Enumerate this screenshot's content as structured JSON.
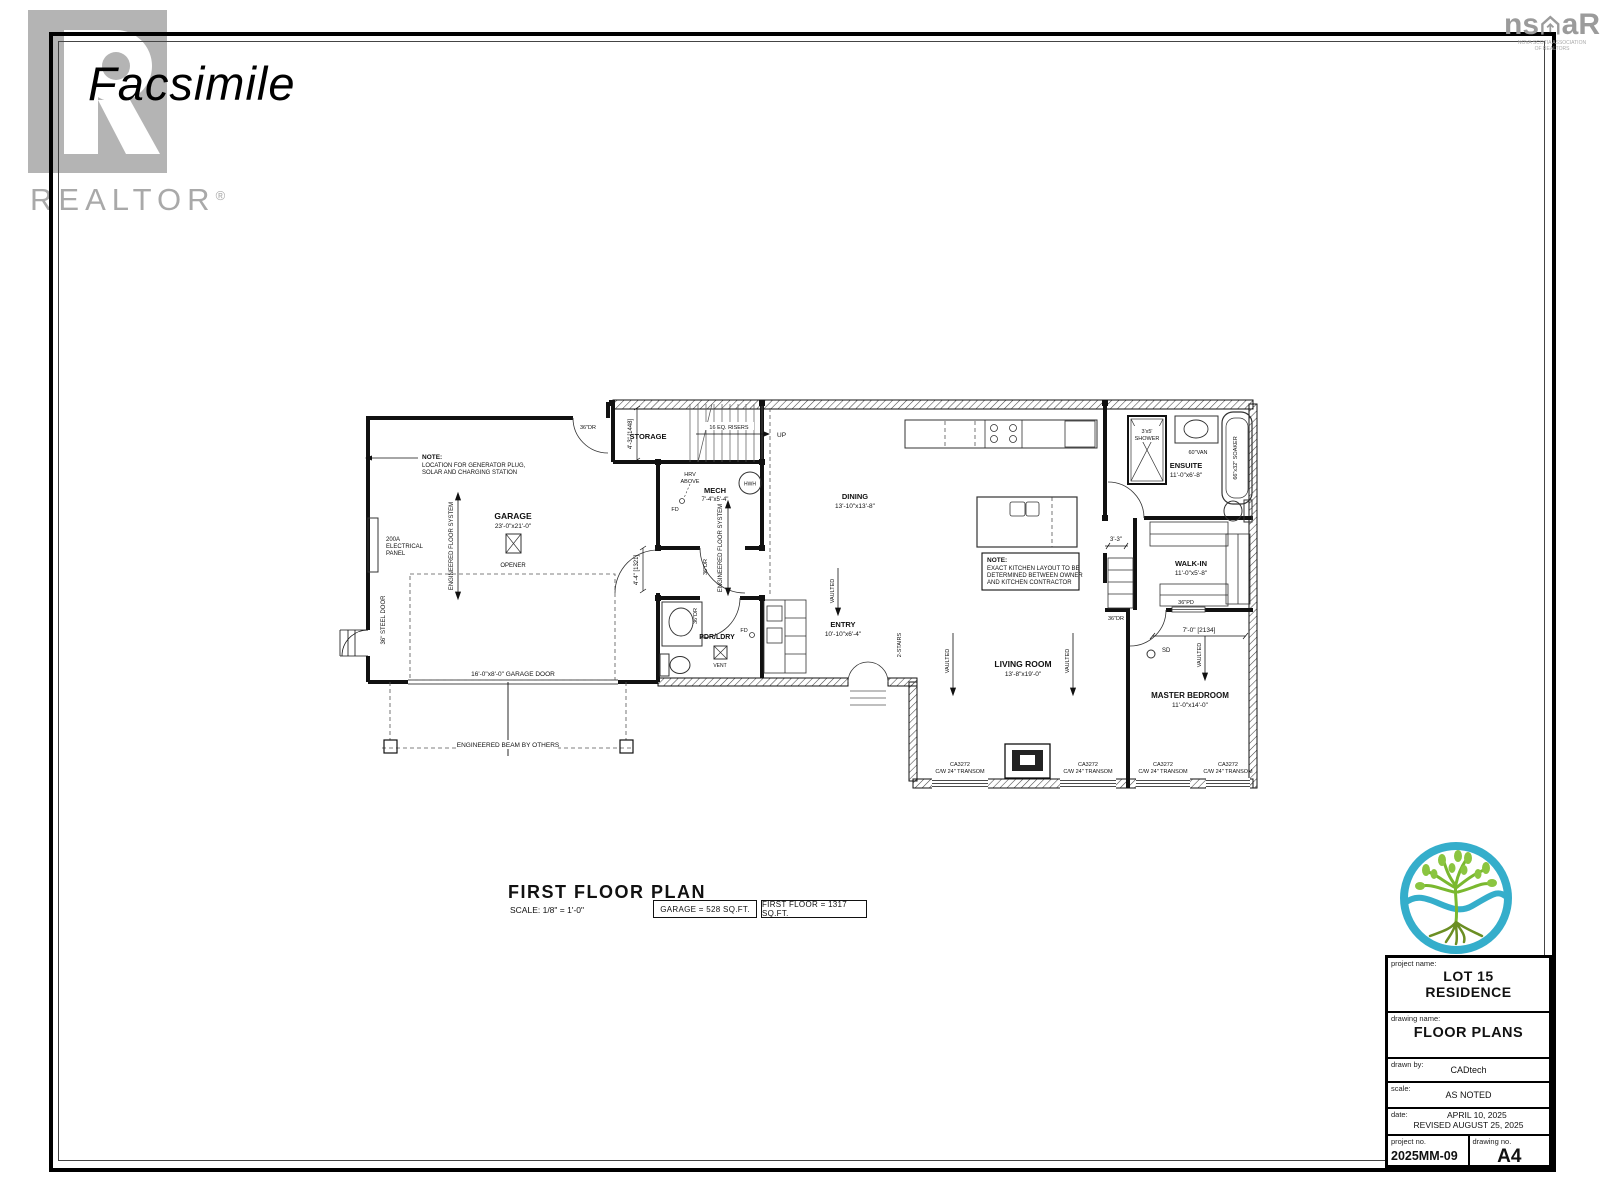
{
  "watermark": {
    "text": "Facsimile"
  },
  "realtor": {
    "wordmark": "REALTOR",
    "reg": "®"
  },
  "nsar": {
    "left": "ns",
    "right": "aR",
    "sub1": "NOVA SCOTIA ASSOCIATION",
    "sub2": "OF REALTORS"
  },
  "plan": {
    "rooms": {
      "garage": {
        "name": "GARAGE",
        "dims": "23'-0\"x21'-0\""
      },
      "storage": {
        "name": "STORAGE"
      },
      "mech": {
        "name": "MECH",
        "dims": "7'-4\"x5'-4\""
      },
      "dining": {
        "name": "DINING",
        "dims": "13'-10\"x13'-8\""
      },
      "pdr": {
        "name": "PDR/LDRY"
      },
      "entry": {
        "name": "ENTRY",
        "dims": "10'-10\"x6'-4\""
      },
      "living": {
        "name": "LIVING ROOM",
        "dims": "13'-8\"x19'-0\""
      },
      "master": {
        "name": "MASTER BEDROOM",
        "dims": "11'-0\"x14'-0\""
      },
      "walkin": {
        "name": "WALK-IN",
        "dims": "11'-0\"x5'-8\""
      },
      "ensuite": {
        "name": "ENSUITE",
        "dims": "11'-0\"x6'-8\""
      }
    },
    "notes": {
      "generator": {
        "title": "NOTE:",
        "l1": "LOCATION FOR GENERATOR PLUG,",
        "l2": "SOLAR AND CHARGING STATION"
      },
      "kitchen": {
        "title": "NOTE:",
        "l1": "EXACT KITCHEN LAYOUT TO BE",
        "l2": "DETERMINED BETWEEN OWNER",
        "l3": "AND KITCHEN CONTRACTOR"
      }
    },
    "ann": {
      "elec1": "200A",
      "elec2": "ELECTRICAL",
      "elec3": "PANEL",
      "eng_floor": "ENGINEERED FLOOR SYSTEM",
      "opener": "OPENER",
      "steel_door": "36\" STEEL DOOR",
      "garage_door": "16'-0\"x8'-0\" GARAGE DOOR",
      "eng_beam": "ENGINEERED BEAM BY OTHERS",
      "risers": "16 EQ. RISERS",
      "up": "UP",
      "hrv1": "HRV",
      "hrv2": "ABOVE",
      "fd": "FD",
      "hwh": "HWH",
      "vent": "VENT",
      "vaulted": "VAULTED",
      "two_stairs": "2-STAIRS",
      "sd": "SD",
      "shower1": "3'x5'",
      "shower2": "SHOWER",
      "van": "60\"VAN",
      "soaker": "66\"x32\" SOAKER",
      "dr36": "36\"DR",
      "pd36": "36\"PD",
      "dim_stair": "4'-3\" [1448]",
      "dim_hall": "4'-4\" [1321]",
      "dim_master": "7'-0\" [2134]",
      "dim_33": "3'-3\"",
      "win_model": "CA3272",
      "win_transom": "C/W 24\" TRANSOM"
    }
  },
  "footer": {
    "title": "FIRST FLOOR PLAN",
    "scale": "SCALE: 1/8\" = 1'-0\"",
    "garage_area": "GARAGE = 528 SQ.FT.",
    "floor_area": "FIRST FLOOR = 1317 SQ.FT."
  },
  "title_block": {
    "project_name_label": "project name:",
    "project_name_1": "LOT 15",
    "project_name_2": "RESIDENCE",
    "drawing_name_label": "drawing name:",
    "drawing_name": "FLOOR PLANS",
    "drawn_by_label": "drawn by:",
    "drawn_by": "CADtech",
    "scale_label": "scale:",
    "scale": "AS NOTED",
    "date_label": "date:",
    "date_1": "APRIL 10, 2025",
    "date_2": "REVISED AUGUST 25, 2025",
    "project_no_label": "project no.",
    "project_no": "2025MM-09",
    "drawing_no_label": "drawing no.",
    "drawing_no": "A4"
  },
  "colors": {
    "accent_teal": "#35aecb",
    "tree_green": "#7ab82f",
    "logo_gray": "#b4b4b4"
  }
}
